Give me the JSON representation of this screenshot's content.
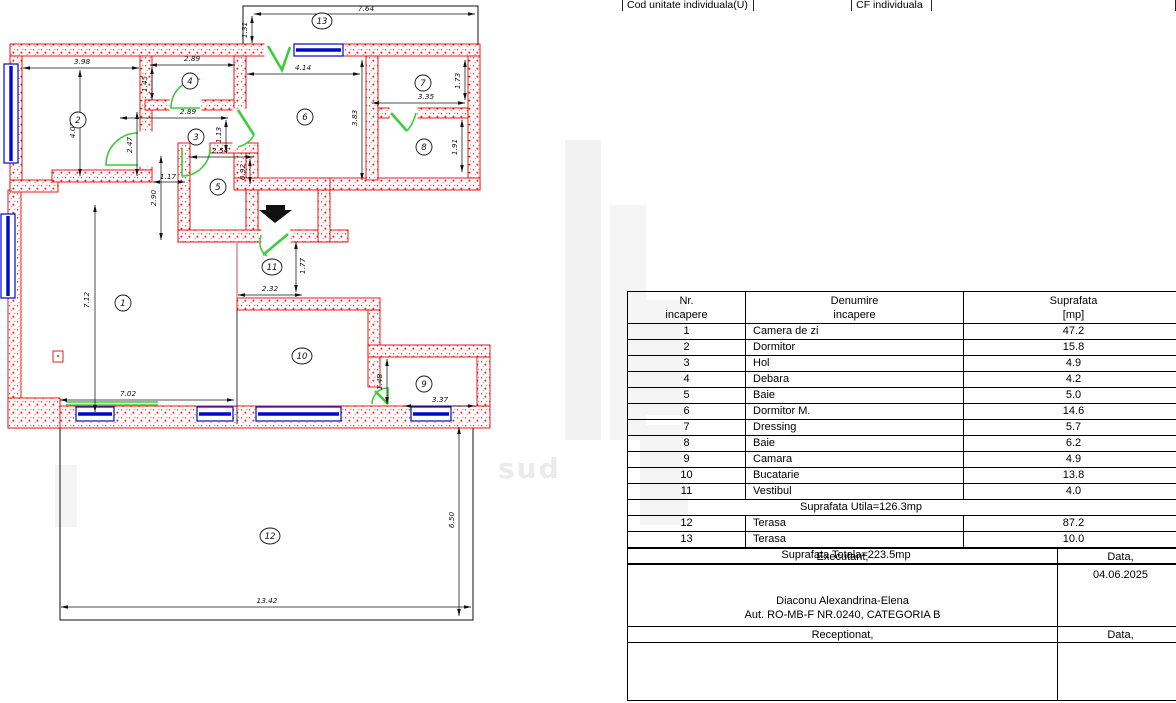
{
  "header_strip": {
    "cells": [
      {
        "label": "Cod unitate individuala(U)"
      },
      {
        "label": ""
      },
      {
        "label": "CF individuala"
      },
      {
        "label": ""
      }
    ]
  },
  "rooms_table": {
    "headers": {
      "nr1": "Nr.",
      "nr2": "incapere",
      "den1": "Denumire",
      "den2": "incapere",
      "sup1": "Suprafata",
      "sup2": "[mp]"
    },
    "rows": [
      {
        "nr": "1",
        "name": "Camera de zi",
        "area": "47.2"
      },
      {
        "nr": "2",
        "name": "Dormitor",
        "area": "15.8"
      },
      {
        "nr": "3",
        "name": "Hol",
        "area": "4.9"
      },
      {
        "nr": "4",
        "name": "Debara",
        "area": "4.2"
      },
      {
        "nr": "5",
        "name": "Baie",
        "area": "5.0"
      },
      {
        "nr": "6",
        "name": "Dormitor M.",
        "area": "14.6"
      },
      {
        "nr": "7",
        "name": "Dressing",
        "area": "5.7"
      },
      {
        "nr": "8",
        "name": "Baie",
        "area": "6.2"
      },
      {
        "nr": "9",
        "name": "Camara",
        "area": "4.9"
      },
      {
        "nr": "10",
        "name": "Bucatarie",
        "area": "13.8"
      },
      {
        "nr": "11",
        "name": "Vestibul",
        "area": "4.0"
      }
    ],
    "subtotal_label": "Suprafata Utila=126.3mp",
    "terrace_rows": [
      {
        "nr": "12",
        "name": "Terasa",
        "area": "87.2"
      },
      {
        "nr": "13",
        "name": "Terasa",
        "area": "10.0"
      }
    ],
    "total_label": "Suprafata Totala=223.5mp"
  },
  "signature_block": {
    "executant_label": "Executant,",
    "data_label": "Data,",
    "date_value": "04.06.2025",
    "name": "Diaconu Alexandrina-Elena",
    "authorization": "Aut. RO-MB-F NR.0240, CATEGORIA B",
    "receptionat_label": "Receptionat,",
    "data_label_2": "Data,"
  },
  "floor_plan": {
    "watermark": "sud",
    "room_labels": [
      {
        "n": "1",
        "x": 123,
        "y": 303
      },
      {
        "n": "2",
        "x": 78,
        "y": 120
      },
      {
        "n": "3",
        "x": 196,
        "y": 137
      },
      {
        "n": "4",
        "x": 190,
        "y": 81
      },
      {
        "n": "5",
        "x": 218,
        "y": 187
      },
      {
        "n": "6",
        "x": 305,
        "y": 117
      },
      {
        "n": "7",
        "x": 423,
        "y": 83
      },
      {
        "n": "8",
        "x": 424,
        "y": 147
      },
      {
        "n": "9",
        "x": 424,
        "y": 384
      },
      {
        "n": "10",
        "x": 302,
        "y": 356
      },
      {
        "n": "11",
        "x": 272,
        "y": 267
      },
      {
        "n": "12",
        "x": 270,
        "y": 536
      },
      {
        "n": "13",
        "x": 322,
        "y": 21
      }
    ],
    "dimensions": [
      {
        "label": "7.64",
        "x1": 254,
        "y1": 14,
        "x2": 475,
        "y2": 14,
        "tx": 366,
        "ty": 11,
        "rot": 0
      },
      {
        "label": "1.31",
        "x1": 252,
        "y1": 16,
        "x2": 252,
        "y2": 43,
        "tx": 247,
        "ty": 30,
        "rot": 1
      },
      {
        "label": "3.98",
        "x1": 23,
        "y1": 68,
        "x2": 139,
        "y2": 68,
        "tx": 82,
        "ty": 64,
        "rot": 0
      },
      {
        "label": "4.07",
        "x1": 80,
        "y1": 70,
        "x2": 80,
        "y2": 176,
        "tx": 75,
        "ty": 130,
        "rot": 1
      },
      {
        "label": "2.89",
        "x1": 150,
        "y1": 65,
        "x2": 235,
        "y2": 65,
        "tx": 192,
        "ty": 61,
        "rot": 0
      },
      {
        "label": "1.45",
        "x1": 152,
        "y1": 67,
        "x2": 152,
        "y2": 100,
        "tx": 147,
        "ty": 84,
        "rot": 1
      },
      {
        "label": "4.14",
        "x1": 247,
        "y1": 74,
        "x2": 360,
        "y2": 74,
        "tx": 303,
        "ty": 70,
        "rot": 0
      },
      {
        "label": "3.83",
        "x1": 362,
        "y1": 60,
        "x2": 362,
        "y2": 180,
        "tx": 357,
        "ty": 118,
        "rot": 1
      },
      {
        "label": "2.89",
        "x1": 120,
        "y1": 118,
        "x2": 228,
        "y2": 118,
        "tx": 188,
        "ty": 114,
        "rot": 0
      },
      {
        "label": "1.13",
        "x1": 226,
        "y1": 120,
        "x2": 226,
        "y2": 152,
        "tx": 221,
        "ty": 135,
        "rot": 1
      },
      {
        "label": "2.47",
        "x1": 137,
        "y1": 112,
        "x2": 137,
        "y2": 176,
        "tx": 132,
        "ty": 145,
        "rot": 1
      },
      {
        "label": "3.35",
        "x1": 372,
        "y1": 103,
        "x2": 465,
        "y2": 103,
        "tx": 426,
        "ty": 99,
        "rot": 0
      },
      {
        "label": "1.73",
        "x1": 465,
        "y1": 60,
        "x2": 465,
        "y2": 100,
        "tx": 460,
        "ty": 81,
        "rot": 1
      },
      {
        "label": "1.91",
        "x1": 462,
        "y1": 120,
        "x2": 462,
        "y2": 172,
        "tx": 457,
        "ty": 147,
        "rot": 1
      },
      {
        "label": "2.54",
        "x1": 190,
        "y1": 157,
        "x2": 253,
        "y2": 157,
        "tx": 220,
        "ty": 153,
        "rot": 0
      },
      {
        "label": "0.92",
        "x1": 250,
        "y1": 159,
        "x2": 250,
        "y2": 184,
        "tx": 245,
        "ty": 172,
        "rot": 1
      },
      {
        "label": "1.17",
        "x1": 153,
        "y1": 182,
        "x2": 185,
        "y2": 182,
        "tx": 168,
        "ty": 179,
        "rot": 0
      },
      {
        "label": "2.90",
        "x1": 161,
        "y1": 156,
        "x2": 161,
        "y2": 240,
        "tx": 156,
        "ty": 198,
        "rot": 1
      },
      {
        "label": "7.12",
        "x1": 95,
        "y1": 205,
        "x2": 95,
        "y2": 412,
        "tx": 89,
        "ty": 300,
        "rot": 1
      },
      {
        "label": "2.32",
        "x1": 238,
        "y1": 295,
        "x2": 302,
        "y2": 295,
        "tx": 270,
        "ty": 291,
        "rot": 0
      },
      {
        "label": "1.77",
        "x1": 296,
        "y1": 242,
        "x2": 296,
        "y2": 292,
        "tx": 305,
        "ty": 266,
        "rot": 1
      },
      {
        "label": "7.02",
        "x1": 60,
        "y1": 400,
        "x2": 234,
        "y2": 400,
        "tx": 128,
        "ty": 396,
        "rot": 0
      },
      {
        "label": "1.48",
        "x1": 387,
        "y1": 359,
        "x2": 387,
        "y2": 404,
        "tx": 382,
        "ty": 382,
        "rot": 1
      },
      {
        "label": "3.37",
        "x1": 404,
        "y1": 406,
        "x2": 475,
        "y2": 406,
        "tx": 440,
        "ty": 402,
        "rot": 0
      },
      {
        "label": "6.50",
        "x1": 459,
        "y1": 427,
        "x2": 459,
        "y2": 616,
        "tx": 454,
        "ty": 520,
        "rot": 1
      },
      {
        "label": "13.42",
        "x1": 61,
        "y1": 607,
        "x2": 471,
        "y2": 607,
        "tx": 267,
        "ty": 603,
        "rot": 0
      }
    ]
  }
}
